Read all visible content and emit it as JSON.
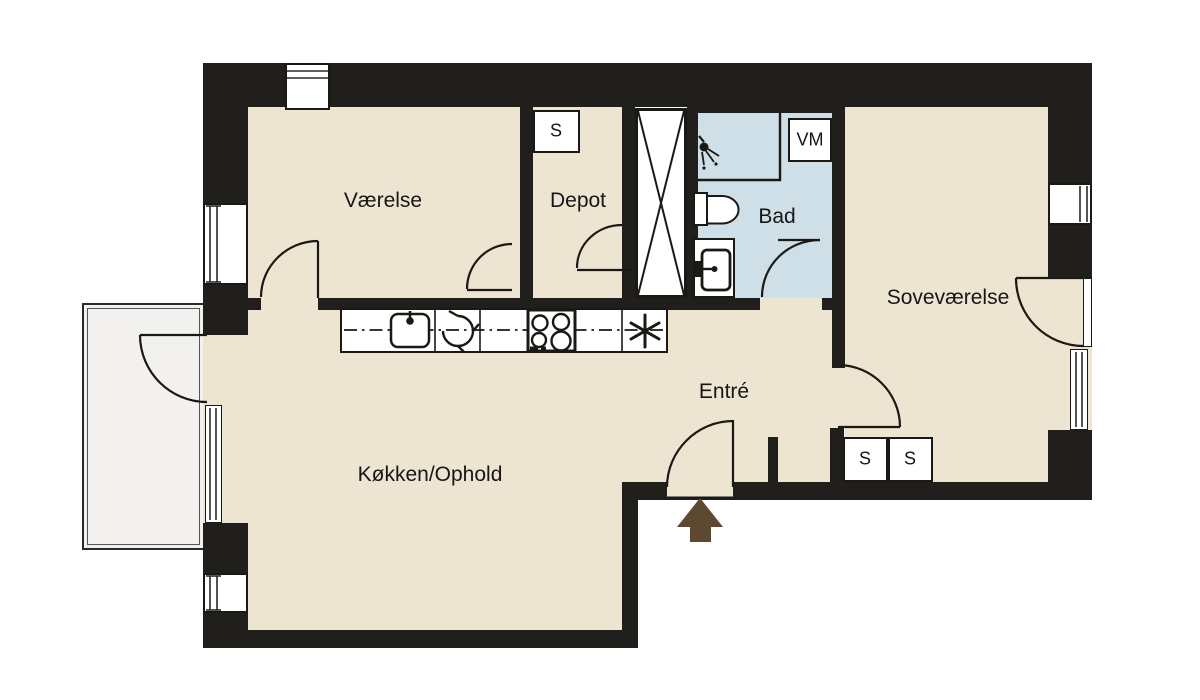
{
  "rooms": {
    "vaerelse": {
      "label": "Værelse"
    },
    "depot": {
      "label": "Depot"
    },
    "bad": {
      "label": "Bad"
    },
    "sovevaerelse": {
      "label": "Soveværelse"
    },
    "entre": {
      "label": "Entré"
    },
    "kokken_ophold": {
      "label": "Køkken/Ophold"
    }
  },
  "fixtures": {
    "washing_machine": "VM",
    "closet_depot": "S",
    "closet_bedroom_1": "S",
    "closet_bedroom_2": "S"
  },
  "colors": {
    "wall": "#211F1C",
    "floor": "#EDE5D2",
    "bath_floor": "#CFDFE7",
    "balcony_floor": "#F2F1EF",
    "entrance_arrow": "#5D4930",
    "background": "#FFFFFF"
  }
}
